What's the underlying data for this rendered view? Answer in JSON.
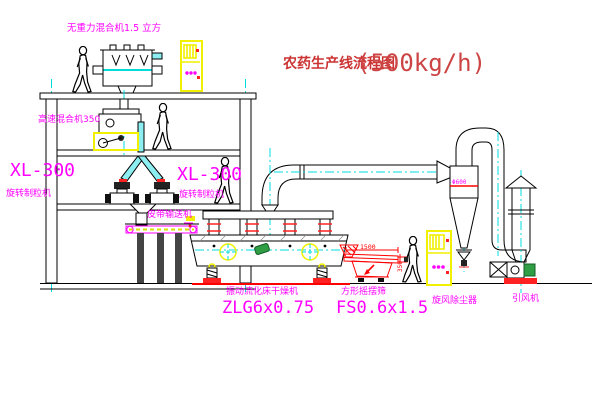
{
  "title": {
    "text": "农药生产线流程图",
    "capacity": "(500kg/h)"
  },
  "labels": {
    "gravity_mixer": "无重力混合机1.5 立方",
    "high_speed_mixer": "高速混合机350",
    "granulator_left": {
      "model": "XL-300",
      "name": "旋转制粒机"
    },
    "granulator_mid": {
      "model": "XL-300",
      "name": "旋转制粒机"
    },
    "belt_conveyor": "皮带输送机",
    "dryer": {
      "name": "振动流化床干燥机",
      "model": "ZLG6x0.75"
    },
    "sieve": {
      "name": "方形摇摆筛",
      "model": "FS0.6x1.5"
    },
    "cyclone": "旋风除尘器",
    "fan": "引风机"
  },
  "dimensions": {
    "sieve_length": "1500",
    "sieve_height": "350",
    "cyclone_diameter": "Φ600"
  },
  "colors": {
    "label_magenta": "#ff00ff",
    "title_red": "#cc3333",
    "drawing_red": "#ff0000",
    "centerline_cyan": "#00dcdc",
    "cabinet_yellow": "#f0f000",
    "line_black": "#000000",
    "motor_green": "#2f9e44"
  }
}
